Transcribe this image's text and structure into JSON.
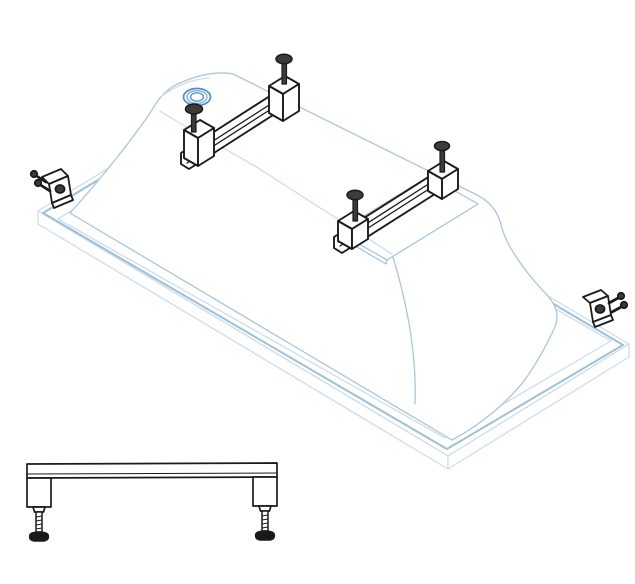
{
  "diagram": {
    "title": "Bathtub leg frame installation diagram",
    "views": [
      {
        "name": "isometric-assembly-view",
        "parts": [
          "bathtub-shell-upside-down",
          "drain-opening",
          "front-mounting-rail",
          "rear-mounting-rail",
          "adjustment-bolt x4",
          "wall-anchor-bracket x2",
          "base-recess-outline"
        ]
      },
      {
        "name": "leg-frame-side-view",
        "parts": [
          "support-rail",
          "leg-block x2",
          "threaded-stem x2",
          "adjustable-foot x2"
        ]
      }
    ]
  },
  "colors": {
    "background": "#ffffff",
    "tub_line": "#aac6db",
    "tub_accent": "#9fc0d8",
    "tub_line_light": "#cdddeb",
    "recess_line": "#a2c3db",
    "drain_ring_outer": "#4f8fcd",
    "drain_ring_mid": "#8ab4de",
    "drain_ring_inner": "#5694d0",
    "hardware_line": "#1b1b1b",
    "bolt_head_fill": "#3b3b3b",
    "foot_fill": "#191919"
  }
}
